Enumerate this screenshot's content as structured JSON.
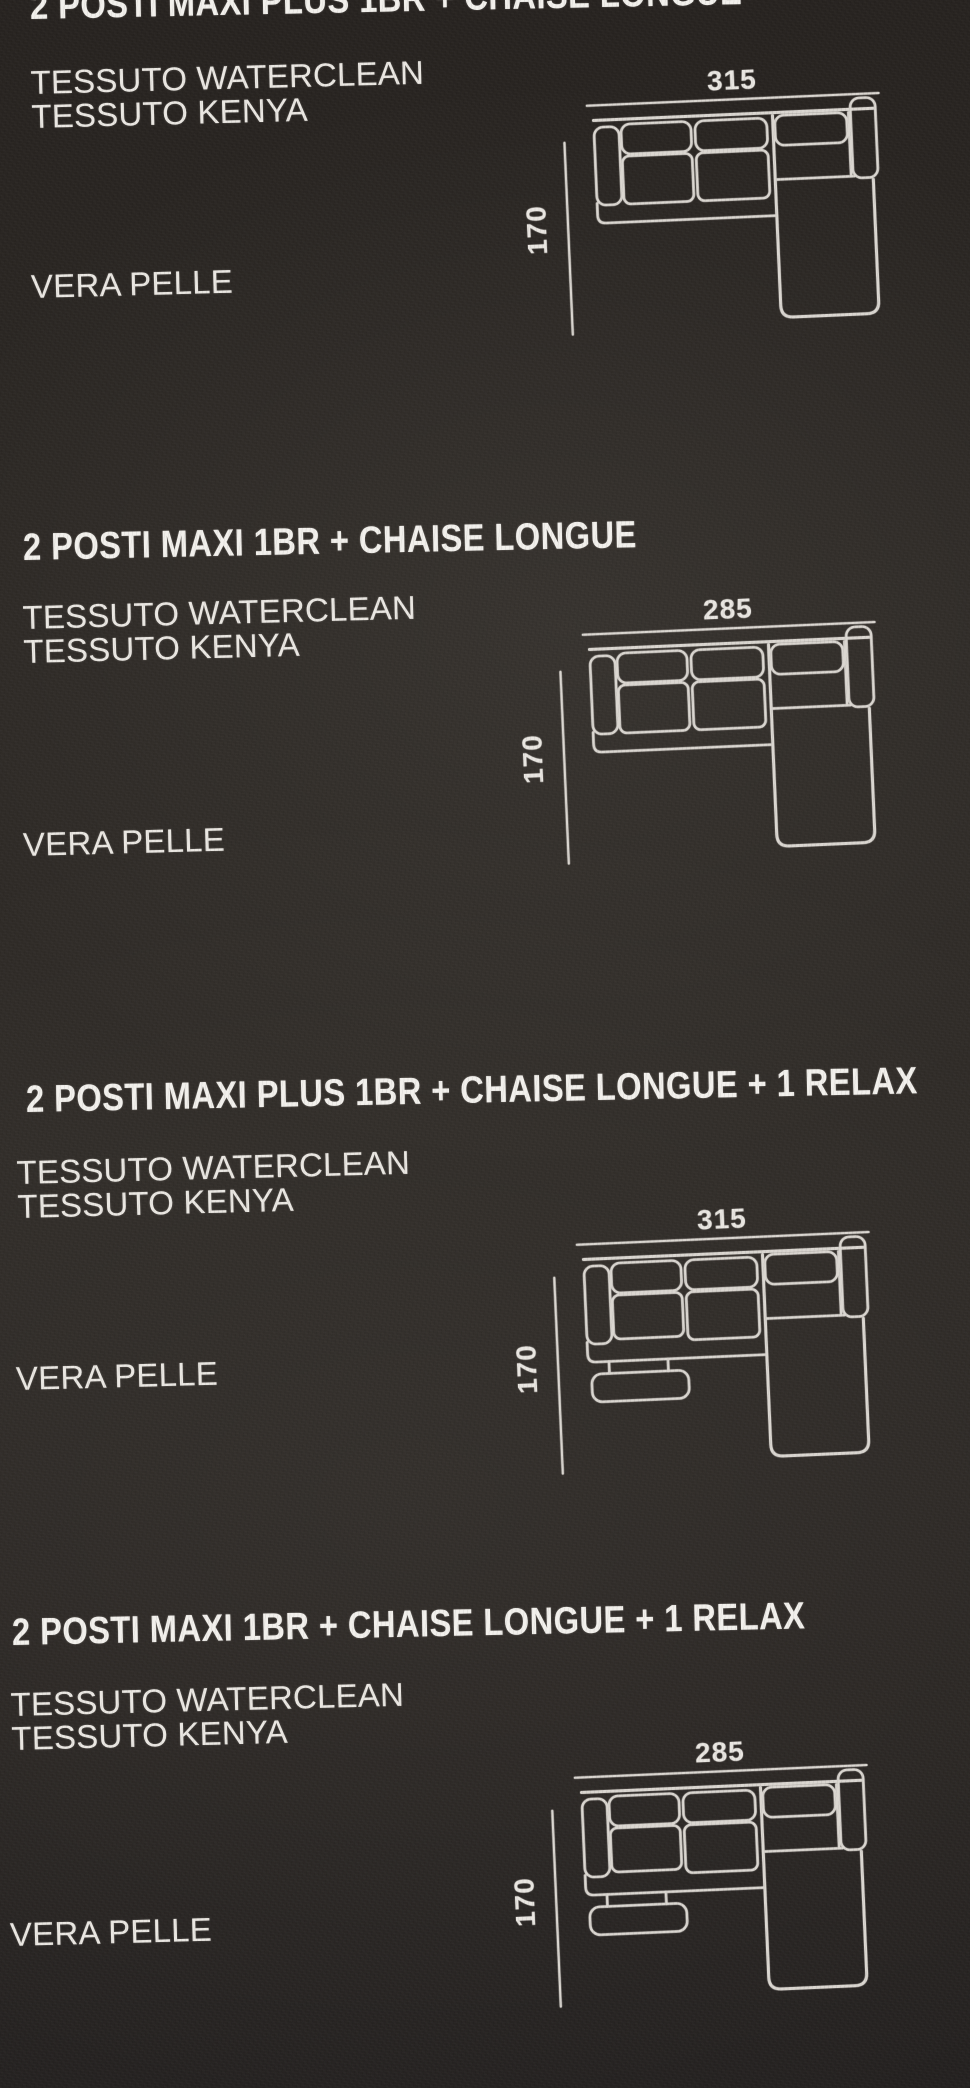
{
  "page": {
    "background_color": "#2d2925",
    "line_color": "#dad6d0",
    "text_color": "#eae7e2",
    "title_color": "#f2f0ec"
  },
  "sections": [
    {
      "title": "2 POSTI MAXI PLUS 1BR + CHAISE LONGUE",
      "fabrics": [
        "TESSUTO WATERCLEAN",
        "TESSUTO KENYA"
      ],
      "leather": "VERA PELLE",
      "width_cm": "315",
      "depth_cm": "170",
      "variant": "chaise-longue"
    },
    {
      "title": "2 POSTI MAXI 1BR + CHAISE LONGUE",
      "fabrics": [
        "TESSUTO WATERCLEAN",
        "TESSUTO KENYA"
      ],
      "leather": "VERA PELLE",
      "width_cm": "285",
      "depth_cm": "170",
      "variant": "chaise-longue"
    },
    {
      "title": "2 POSTI MAXI PLUS 1BR + CHAISE LONGUE + 1 RELAX",
      "fabrics": [
        "TESSUTO WATERCLEAN",
        "TESSUTO KENYA"
      ],
      "leather": "VERA PELLE",
      "width_cm": "315",
      "depth_cm": "170",
      "variant": "chaise-longue-relax"
    },
    {
      "title": "2 POSTI MAXI 1BR + CHAISE LONGUE + 1 RELAX",
      "fabrics": [
        "TESSUTO WATERCLEAN",
        "TESSUTO KENYA"
      ],
      "leather": "VERA PELLE",
      "width_cm": "285",
      "depth_cm": "170",
      "variant": "chaise-longue-relax"
    }
  ]
}
